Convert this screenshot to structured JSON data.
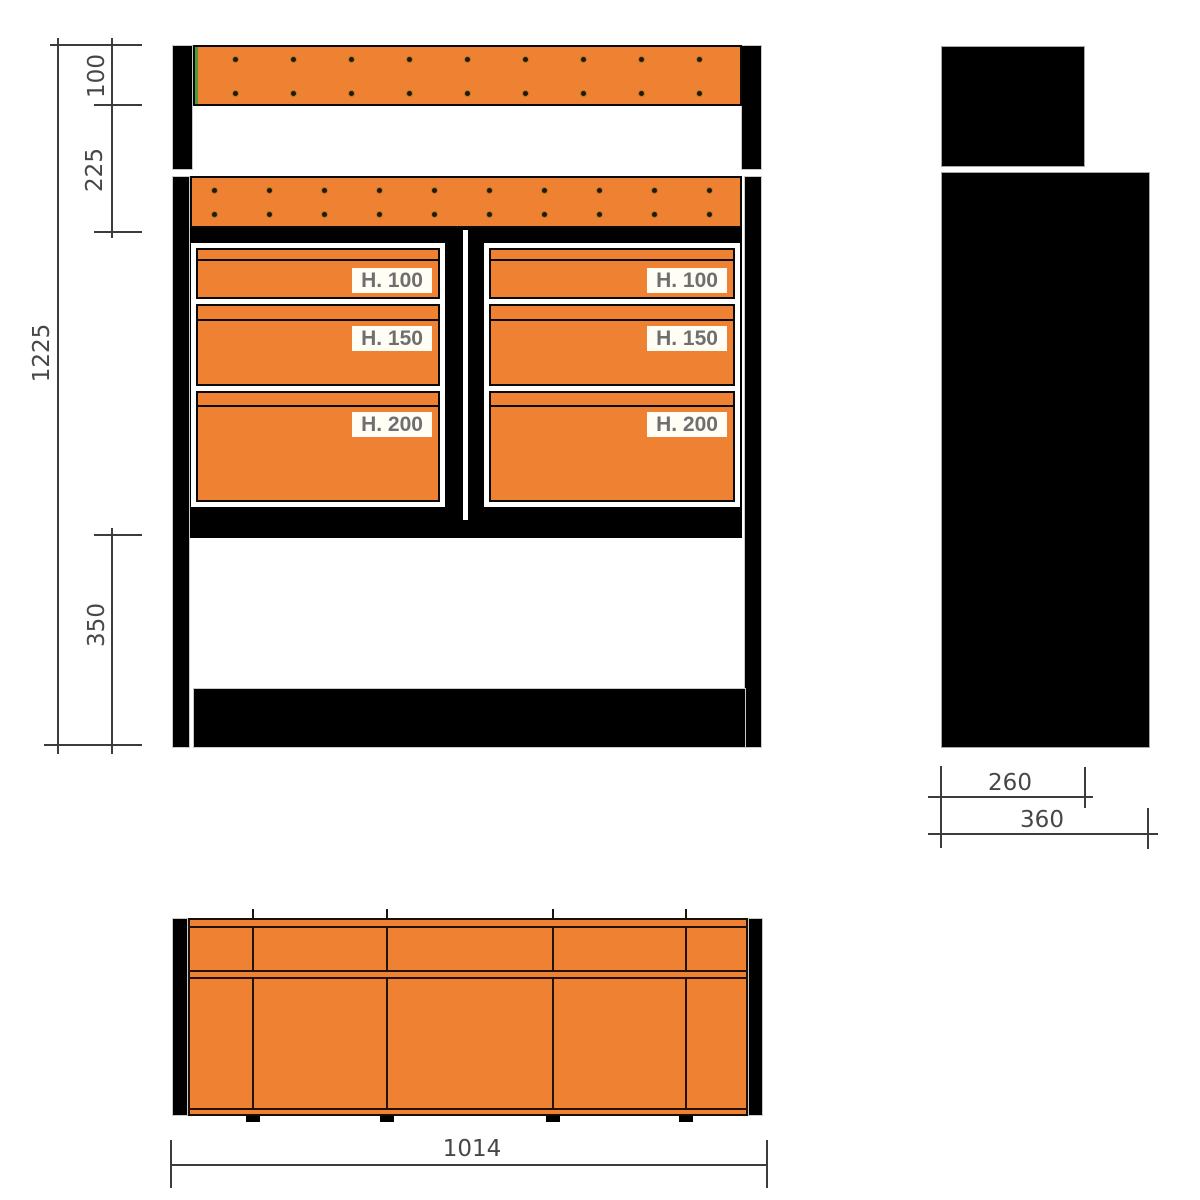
{
  "meta": {
    "type": "technical-drawing",
    "subject": "Van racking / drawer unit — front elevation, side elevation and plan view"
  },
  "colors": {
    "orange": "#ef8132",
    "frame_black": "#000000",
    "green_edge": "#4f9b3c",
    "dim_line": "#3c3c3c",
    "dim_text": "#474747",
    "label_text": "#6f6f6f",
    "label_bg": "#fffdf4"
  },
  "front_view": {
    "dims": {
      "top_panel_height": "100",
      "upper_section_height": "225",
      "total_height": "1225",
      "base_section_height": "350"
    },
    "columns": [
      {
        "drawers": [
          {
            "label": "H. 100"
          },
          {
            "label": "H. 150"
          },
          {
            "label": "H. 200"
          }
        ]
      },
      {
        "drawers": [
          {
            "label": "H. 100"
          },
          {
            "label": "H. 150"
          },
          {
            "label": "H. 200"
          }
        ]
      }
    ]
  },
  "side_view": {
    "dims": {
      "upper_depth": "260",
      "total_depth": "360"
    }
  },
  "plan_view": {
    "dims": {
      "total_width": "1014"
    }
  }
}
